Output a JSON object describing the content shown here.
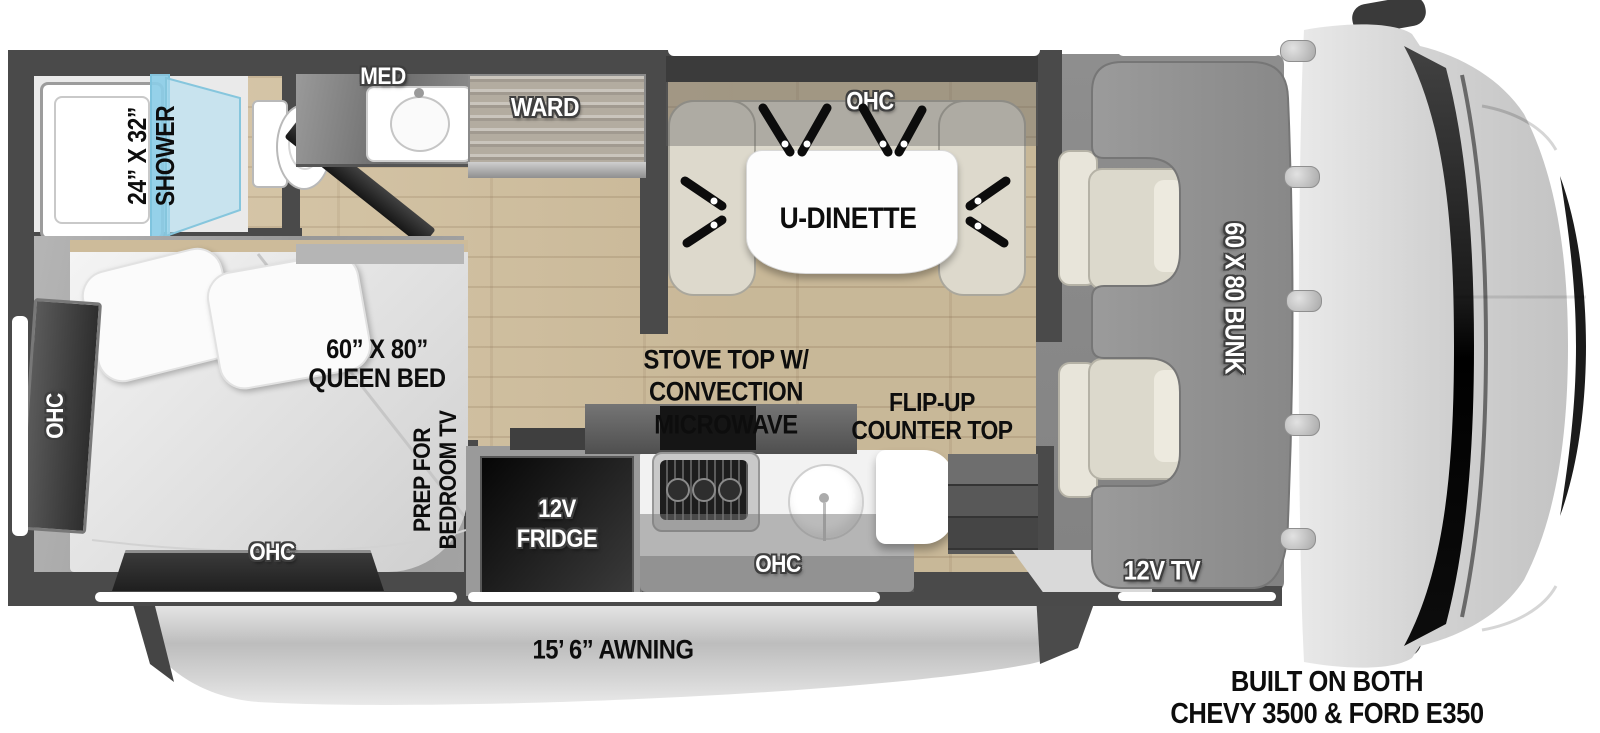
{
  "bathroom": {
    "shower_size": "24” X 32”",
    "shower": "SHOWER",
    "med": "MED",
    "ward": "WARD"
  },
  "dinette": {
    "ohc": "OHC",
    "label": "U-DINETTE"
  },
  "bedroom": {
    "bed_size": "60” X 80”",
    "bed": "QUEEN BED",
    "ohc_side": "OHC",
    "ohc_rear": "OHC",
    "tv_prep_line1": "PREP FOR",
    "tv_prep_line2": "BEDROOM TV"
  },
  "kitchen": {
    "fridge_line1": "12V",
    "fridge_line2": "FRIDGE",
    "stove_line1": "STOVE TOP W/",
    "stove_line2": "CONVECTION",
    "stove_line3": "MICROWAVE",
    "flip_line1": "FLIP-UP",
    "flip_line2": "COUNTER TOP",
    "ohc": "OHC"
  },
  "cab": {
    "bunk": "60 X 80 BUNK",
    "tv": "12V TV"
  },
  "exterior": {
    "awning": "15’ 6” AWNING",
    "chassis_line1": "BUILT ON BOTH",
    "chassis_line2": "CHEVY 3500 & FORD E350"
  },
  "colors": {
    "wall": "#4a4a4a",
    "wood_floor": "#d5c3a1",
    "bedroom_carpet": "#a8a8a8",
    "shower_glass": "#a2d8ec",
    "awning_silver": "#c9c9c9",
    "cab_floor": "#8a8a8a",
    "bunk_gray": "#949494",
    "fridge_black": "#111111",
    "text_black": "#0d0d0d",
    "text_white": "#ffffff"
  }
}
